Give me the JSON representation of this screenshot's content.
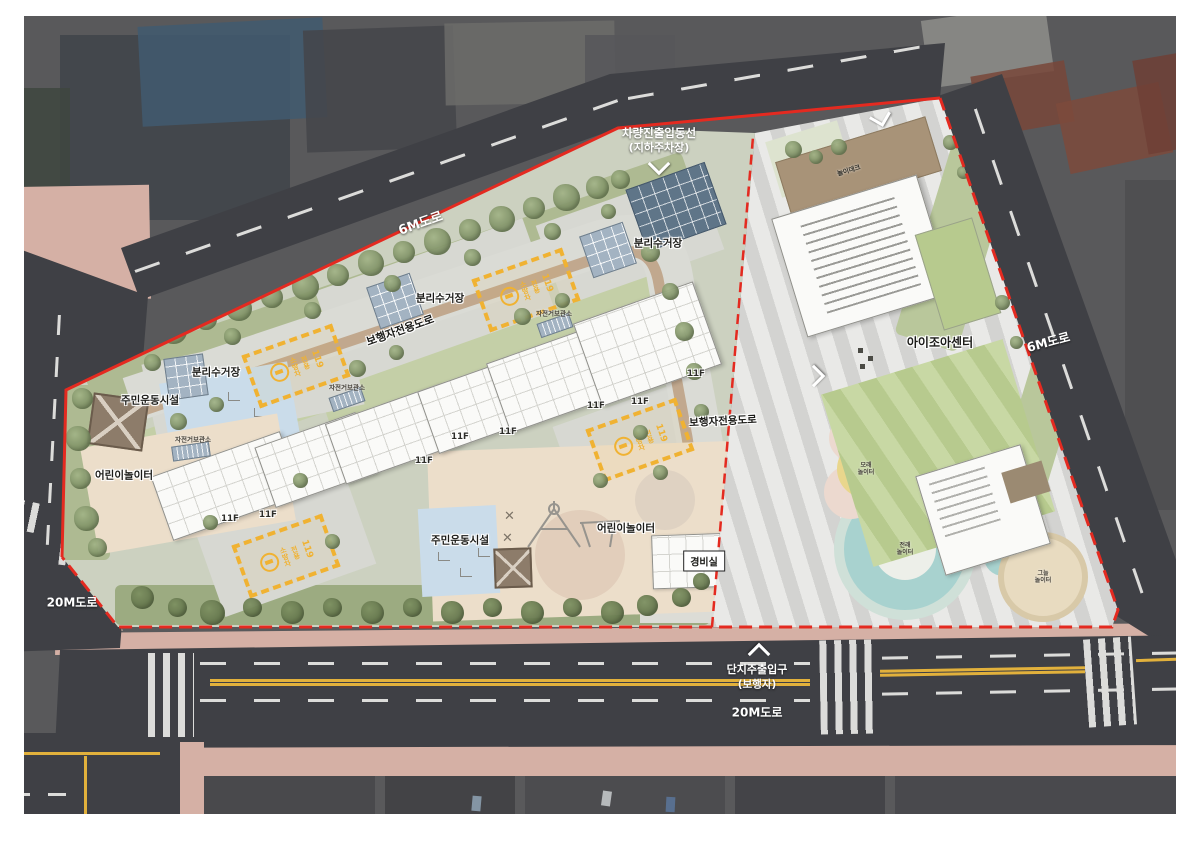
{
  "colors": {
    "aerial_bg": "#59595b",
    "road": "#3f4045",
    "lane_white": "#dcdcda",
    "lane_yellow": "#e2b13c",
    "sidewalk_pink": "#d5b0a5",
    "boundary_red": "#e42a20",
    "site_base": "#ccd1c0",
    "greenery": "#aeba92",
    "tree_light": "#a3b488",
    "tree_mid": "#77895f",
    "path_gray": "#dadbd5",
    "path_tan": "#c1a88e",
    "plaza_gray": "#d7d8d2",
    "building_white": "#fafaf8",
    "fire_yellow": "#f0b232",
    "recycle_blue": "#a3b3c2",
    "skylight_blue": "#5f7588",
    "exercise_blue": "#cadcea",
    "playground_cream": "#ecdeca",
    "stripe_a": "#e9e9e7",
    "stripe_b": "#d3d3d1",
    "yard_green_a": "#c8d8a4",
    "yard_green_b": "#b7ca8e",
    "deck_brown": "#a89378",
    "teal": "#a8d2cf",
    "teal_ring": "#cfe0d8",
    "sand_yellow": "#e9d68c",
    "beige_circle": "#e8dbc0",
    "pink_circle": "#ecd9cf"
  },
  "roads": {
    "top_label": "6M도로",
    "right_label": "6M도로",
    "left_label": "20M도로",
    "bottom_label": "20M도로"
  },
  "entrances": {
    "vehicle": {
      "line1": "차량진출입동선",
      "line2": "(지하주차장)"
    },
    "main": {
      "line1": "단지주출입구",
      "line2": "(보행자)"
    }
  },
  "site": {
    "pedestrian_road_label": "보행자전용도로",
    "recycling_label": "분리수거장",
    "bicycle_label": "자전거보관소",
    "exercise_label": "주민운동시설",
    "playground_label": "어린이놀이터",
    "guard_label": "경비실",
    "floor_label": "11F",
    "fire_lane": {
      "word1": "소방차",
      "word2": "전용",
      "number": "119"
    }
  },
  "daycare": {
    "name": "아이조아센터",
    "deck_label": "놀이데크",
    "play_areas": {
      "sand": {
        "line1": "모래",
        "line2": "놀이터"
      },
      "traditional": {
        "line1": "전래",
        "line2": "놀이터"
      },
      "shade": {
        "line1": "그늘",
        "line2": "놀이터"
      }
    }
  }
}
